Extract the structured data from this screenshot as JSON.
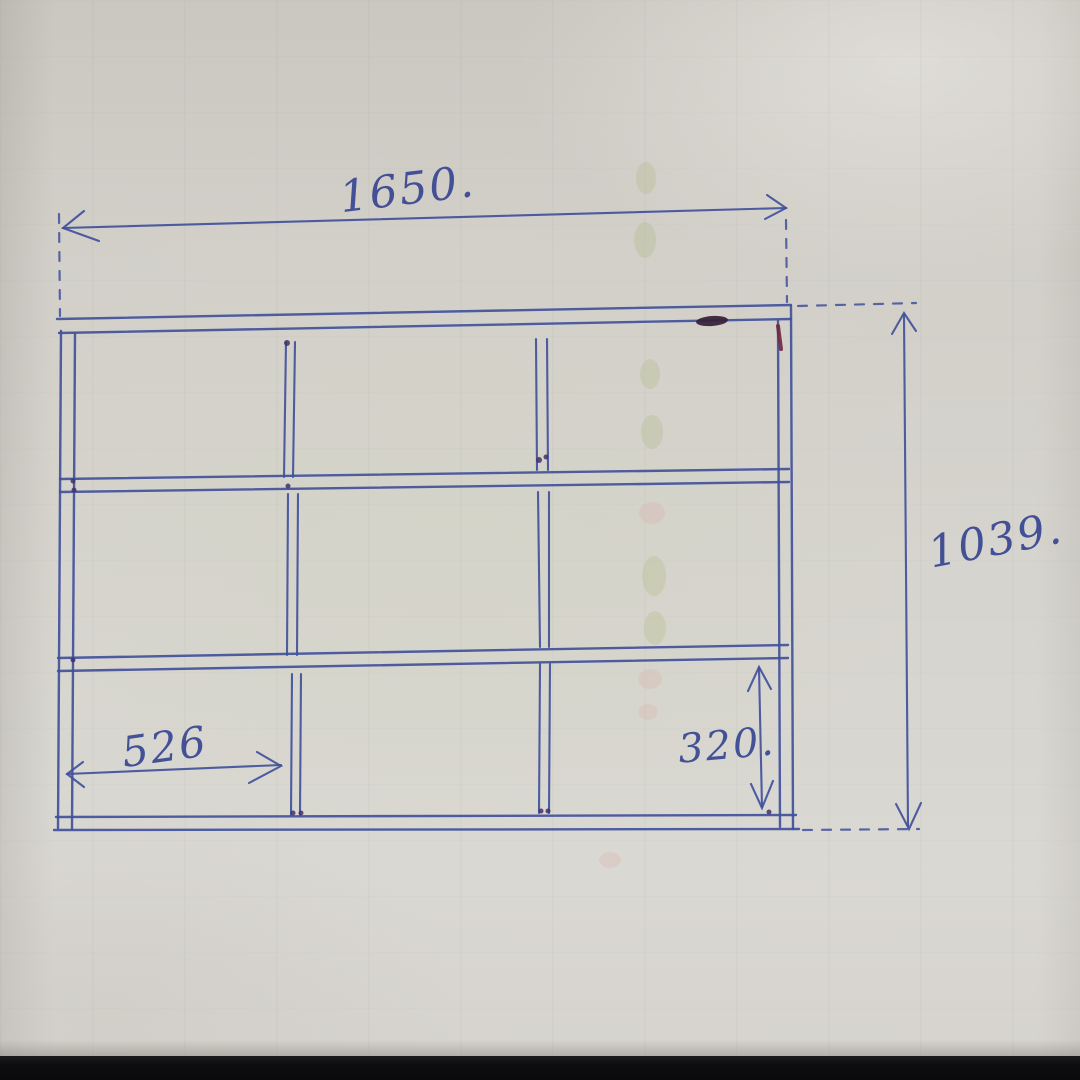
{
  "sketch": {
    "ink_color": "#41509b",
    "paper_color": "#d4d1cb",
    "desk_color": "#0d0c0f",
    "grid": {
      "rows": 3,
      "columns": 3
    },
    "dimensions": {
      "overall_width": {
        "label": "1650.",
        "value": 1650
      },
      "overall_height": {
        "label": "1039.",
        "value": 1039
      },
      "cell_width": {
        "label": "526",
        "value": 526
      },
      "cell_height": {
        "label": "320.",
        "value": 320
      }
    }
  }
}
